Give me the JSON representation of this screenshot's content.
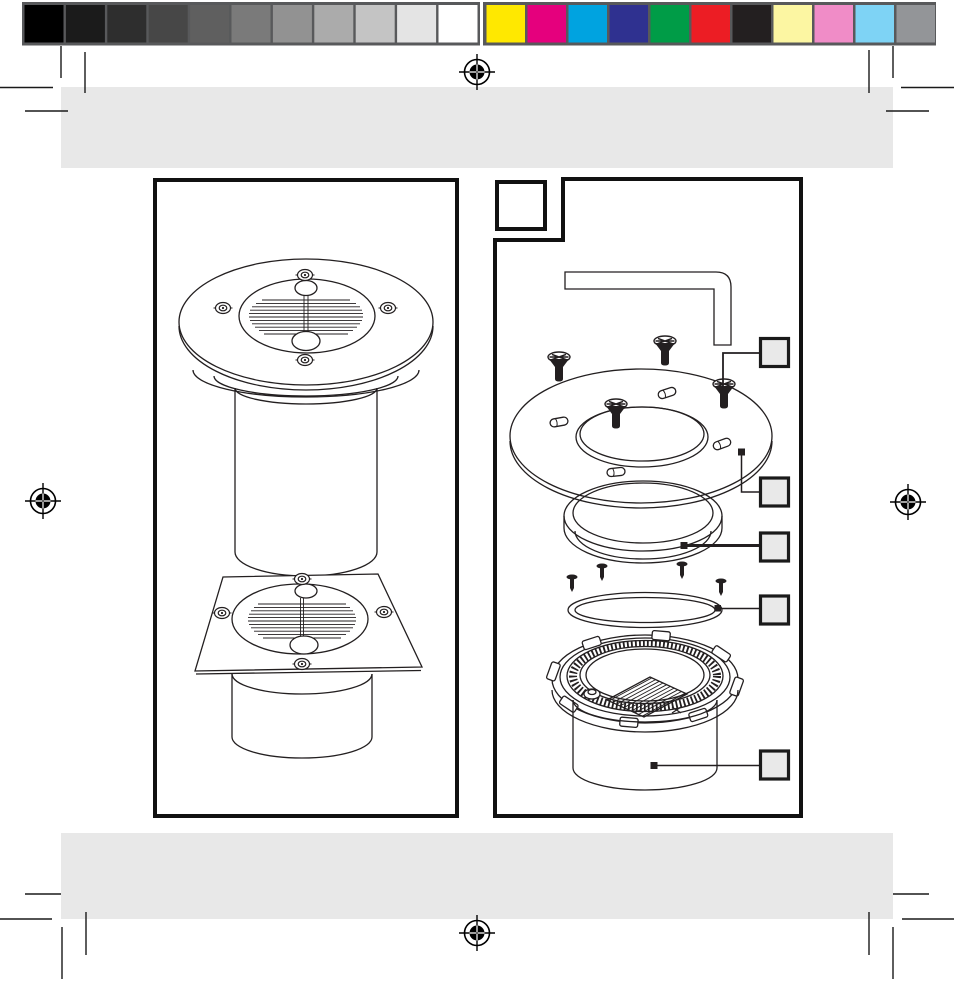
{
  "page": {
    "bg": "#FFFFFF",
    "kind": "print-proof page of a solar ground light instruction manual (no visible text)"
  },
  "calibration": {
    "bar_border": "#58595B",
    "grayscale": [
      "#000000",
      "#1B1B1B",
      "#2E2E2E",
      "#474747",
      "#5F5F5F",
      "#7A7A7A",
      "#929292",
      "#ABABAB",
      "#C4C4C4",
      "#E4E4E4",
      "#FFFFFF"
    ],
    "colors": [
      "#FFE800",
      "#E5007D",
      "#00A3E0",
      "#2F3190",
      "#009C47",
      "#EC1D24",
      "#231F20",
      "#FCF6A2",
      "#F08CC7",
      "#7ED3F5",
      "#939598"
    ]
  },
  "marks": {
    "registration_color": "#000000",
    "crop_color": "#1A1A1A",
    "registration_count": "4"
  },
  "bands": {
    "fill": "#E8E8E8"
  },
  "artwork": {
    "line_color": "#231F20",
    "panel_border": "#111111",
    "callout_fill": "#E9E9E9",
    "callout_count": "5",
    "left_panel_figures": [
      "round solar ground light",
      "square solar ground light"
    ],
    "right_panel_parts": [
      "hex key",
      "cover-ring screws",
      "cover ring",
      "glass lens",
      "lens screws",
      "o-ring seal",
      "lamp housing with solar cell"
    ]
  }
}
